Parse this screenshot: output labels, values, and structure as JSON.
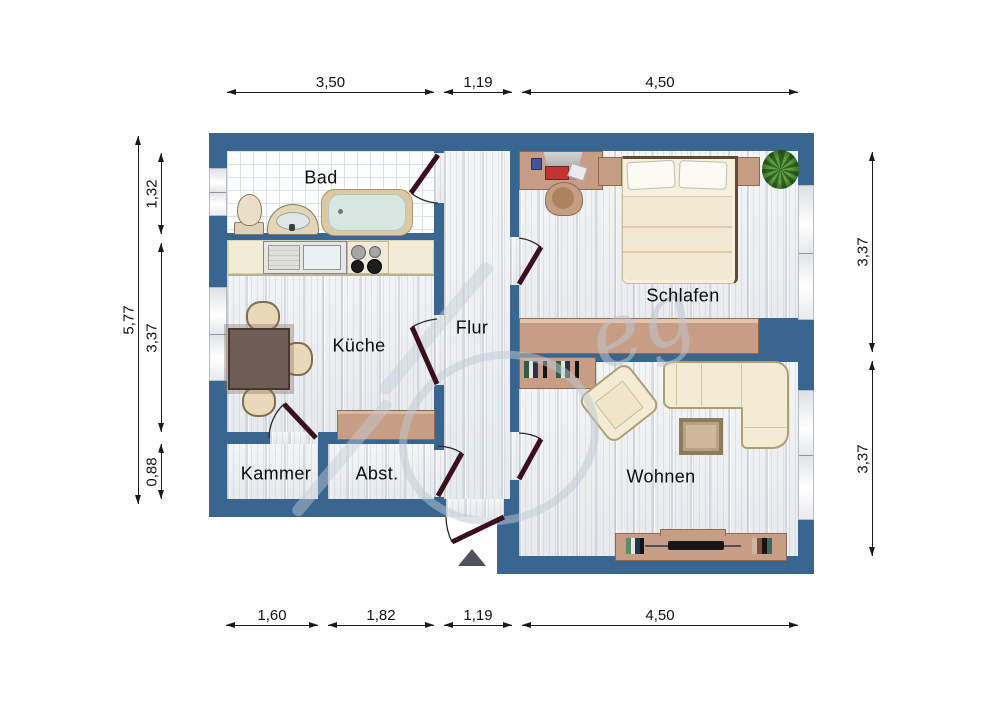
{
  "rooms": {
    "bad": "Bad",
    "kueche": "Küche",
    "flur": "Flur",
    "schlafen": "Schlafen",
    "kammer": "Kammer",
    "abstellraum": "Abst.",
    "wohnen": "Wohnen"
  },
  "dimensions": {
    "top": [
      "3,50",
      "1,19",
      "4,50"
    ],
    "bottom": [
      "1,60",
      "1,82",
      "1,19",
      "4,50"
    ],
    "left_outer": "5,77",
    "left_inner": [
      "1,32",
      "3,37",
      "0,88"
    ],
    "right": [
      "3,37",
      "3,37"
    ]
  },
  "watermark": "eg",
  "colors": {
    "wall": "#396691",
    "door_leaf": "#3a0f1e",
    "furniture_tan": "#c79e85",
    "furniture_cream": "#f3ebd4",
    "dimension_line": "#1a1a1a"
  }
}
